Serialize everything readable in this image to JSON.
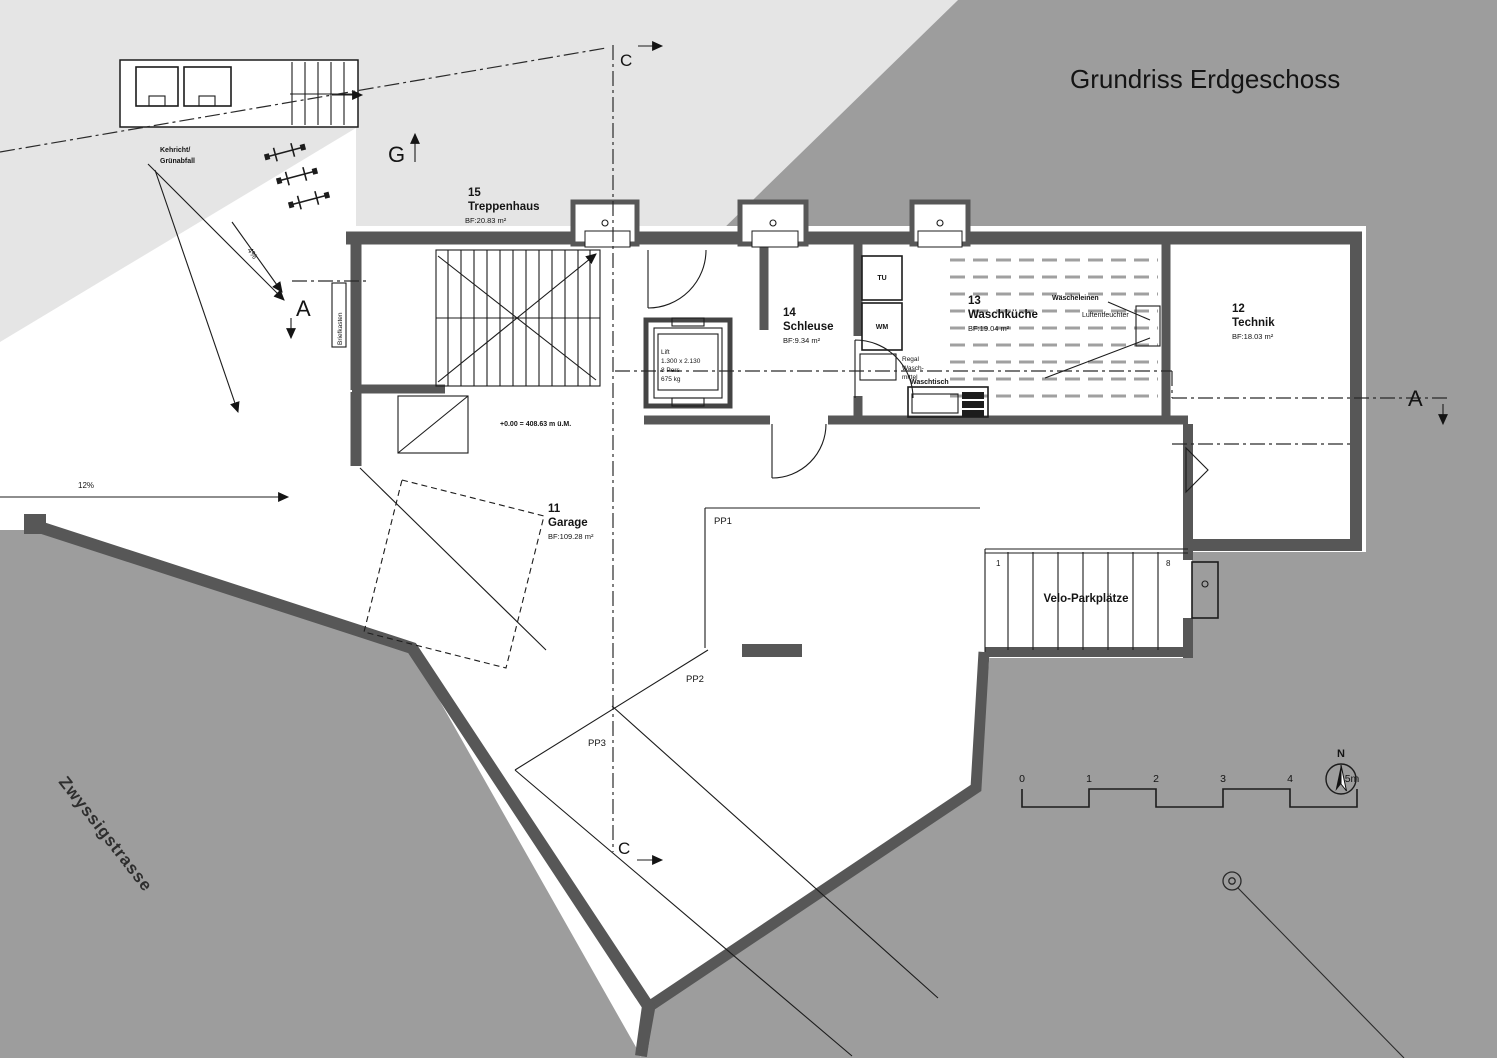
{
  "title": "Grundriss Erdgeschoss",
  "rooms": {
    "treppenhaus": {
      "number": "15",
      "name": "Treppenhaus",
      "area": "BF:20.83 m²"
    },
    "schleuse": {
      "number": "14",
      "name": "Schleuse",
      "area": "BF:9.34 m²"
    },
    "waschkueche": {
      "number": "13",
      "name": "Waschküche",
      "area": "BF:19.04 m²"
    },
    "technik": {
      "number": "12",
      "name": "Technik",
      "area": "BF:18.03 m²"
    },
    "garage": {
      "number": "11",
      "name": "Garage",
      "area": "BF:109.28 m²"
    }
  },
  "lift": {
    "line1": "Lift",
    "line2": "1.300 x 2.130",
    "line3": "8 Pers",
    "line4": "675 kg"
  },
  "laundry": {
    "tu": "TU",
    "wm": "WM",
    "regal1": "Regal",
    "regal2": "Wasch-",
    "regal3": "mittel",
    "waschtisch": "Waschtisch",
    "waescheleinen": "Wäscheleinen",
    "luftentfeuchter": "Luftentfeuchter"
  },
  "parking": {
    "pp1": "PP1",
    "pp2": "PP2",
    "pp3": "PP3",
    "velo": "Velo-Parkplätze",
    "velo_first": "1",
    "velo_last": "8"
  },
  "site": {
    "street": "Zwyssigstrasse",
    "kehricht1": "Kehricht/",
    "kehricht2": "Grünabfall",
    "briefkasten": "Briefkasten",
    "level": "+0.00 = 408.63 m ü.M.",
    "slope_ramp": "12%",
    "slope_path": "4%"
  },
  "sections": {
    "g": "G",
    "a_left": "A",
    "a_right": "A",
    "c_top": "C",
    "c_bottom": "C"
  },
  "scalebar": {
    "t0": "0",
    "t1": "1",
    "t2": "2",
    "t3": "3",
    "t4": "4",
    "t5": "5m"
  },
  "north_label": "N",
  "colors": {
    "paper": "#ffffff",
    "light_area": "#e5e5e5",
    "site_gray": "#9d9d9d",
    "wall": "#575757",
    "line": "#1c1c1c",
    "clothesline": "#a0a0a0"
  }
}
